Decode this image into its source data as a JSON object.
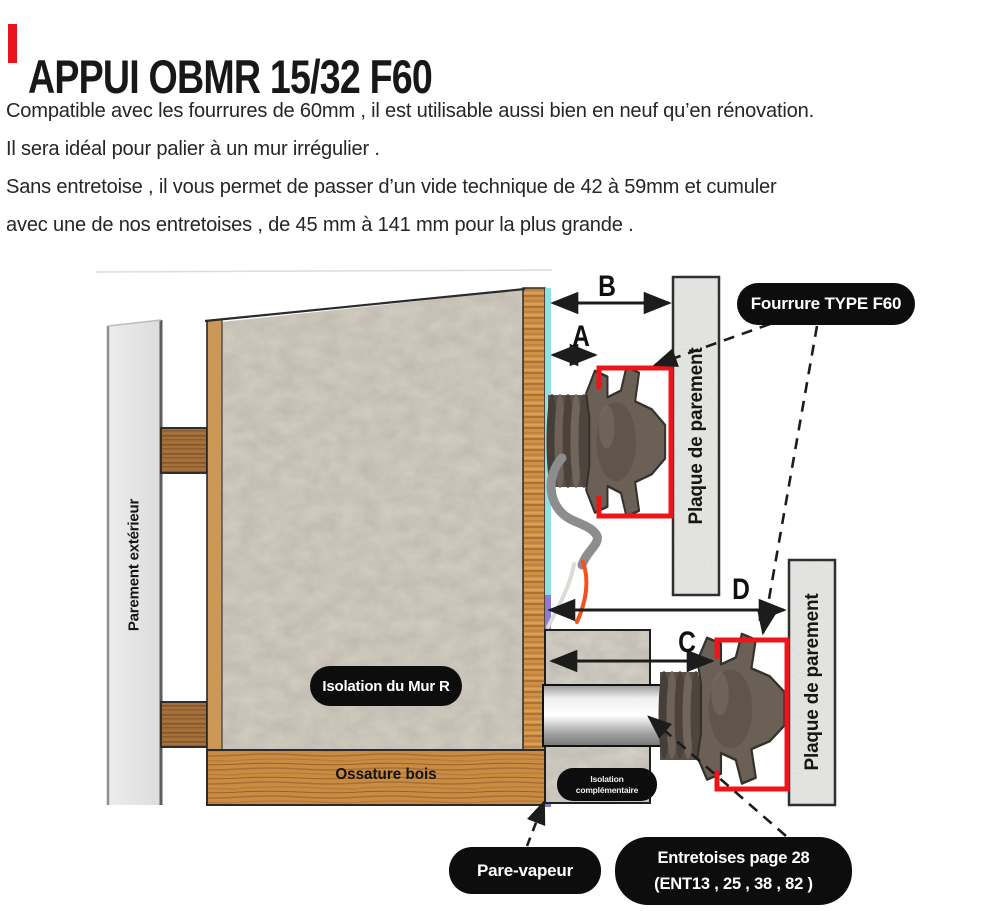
{
  "header": {
    "title": "APPUI OBMR 15/32 F60",
    "paragraph_lines": [
      "Compatible avec les fourrures de 60mm , il est utilisable aussi bien en neuf qu’en rénovation.",
      "Il sera idéal pour palier à un mur irrégulier .",
      "Sans entretoise , il vous permet de passer d’un vide technique de 42 à 59mm et cumuler",
      "avec une de nos entretoises , de 45 mm à 141 mm pour la plus grande ."
    ]
  },
  "diagram": {
    "labels": {
      "parement_exterieur": "Parement extérieur",
      "isolation_mur": "Isolation du Mur R",
      "ossature_bois": "Ossature bois",
      "plaque_parement_haut": "Plaque de parement",
      "plaque_parement_bas": "Plaque de parement",
      "isolation_complementaire_line1": "Isolation",
      "isolation_complementaire_line2": "complémentaire",
      "fourrure": "Fourrure TYPE F60",
      "pare_vapeur": "Pare-vapeur",
      "entretoises_line1": "Entretoises page 28",
      "entretoises_line2": "(ENT13 , 25 , 38 , 82 )"
    },
    "dimensions": {
      "a": "A",
      "b": "B",
      "c": "C",
      "d": "D"
    },
    "colors": {
      "accent_red": "#e8131b",
      "fourrure_profile_red": "#ee1418",
      "pill_black": "#0d0d0d",
      "membrane_cyan": "#8fe1e6",
      "pare_vapeur_purple": "#8f7ad0",
      "wood_orange": "#cd9045",
      "insulation_grey": "#d6d0c4"
    }
  }
}
